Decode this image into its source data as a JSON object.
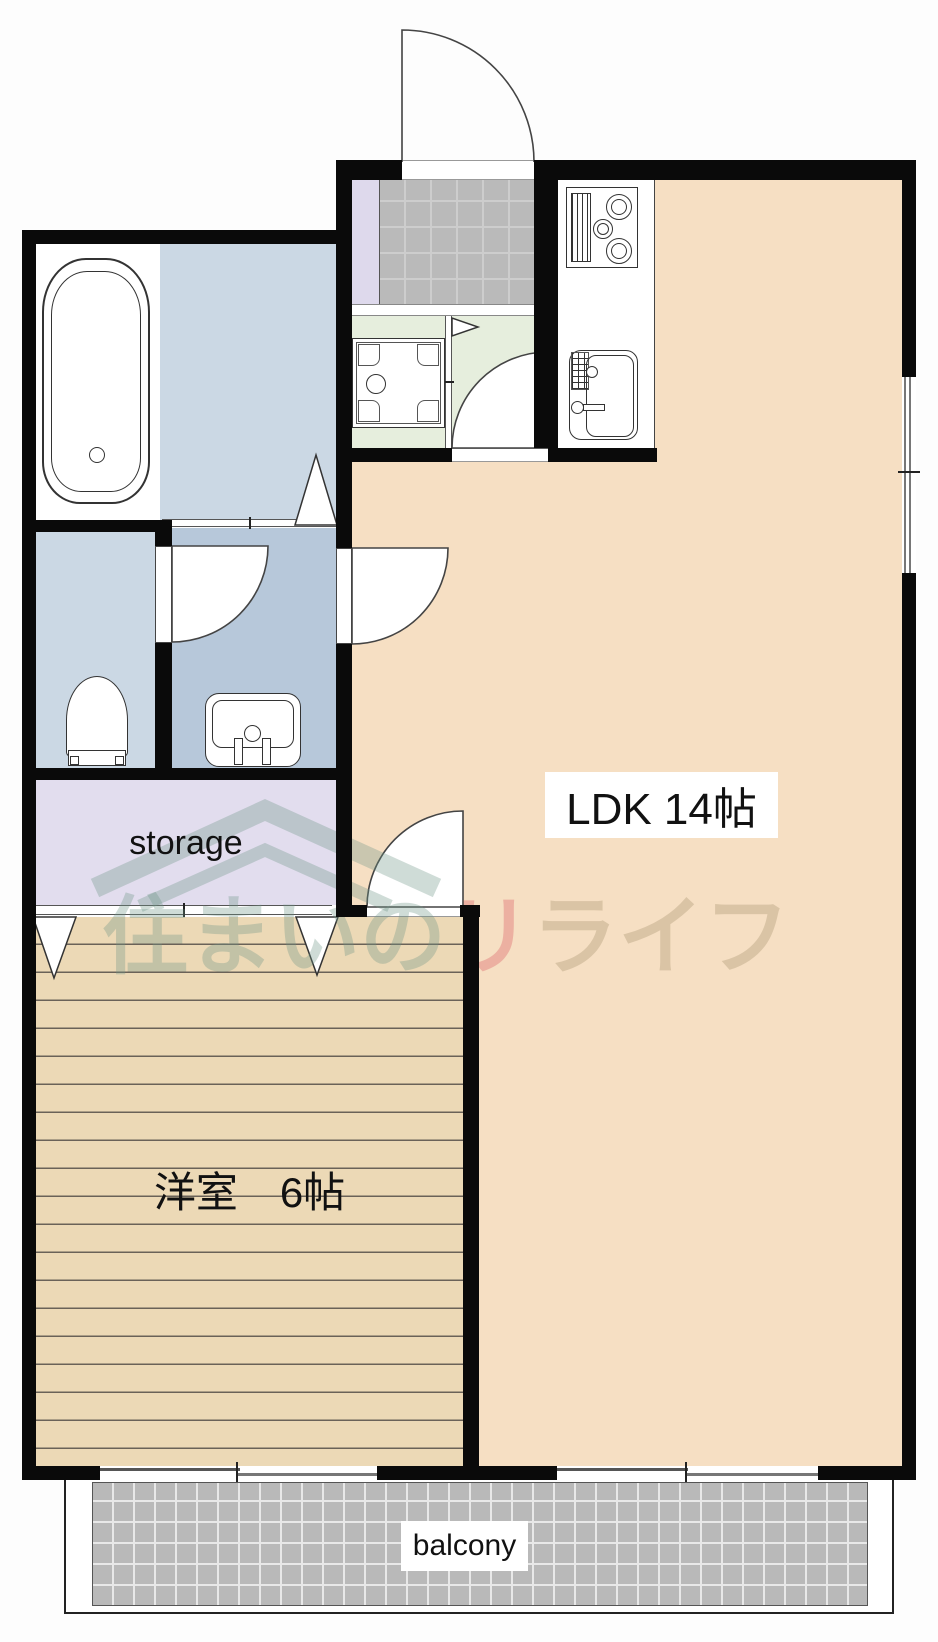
{
  "title": "apartment floor plan",
  "rooms": {
    "ldk": {
      "label": "LDK 14帖"
    },
    "western": {
      "label": "洋室　6帖"
    },
    "storage": {
      "label": "storage"
    },
    "balcony": {
      "label": "balcony"
    }
  },
  "watermark": {
    "gray": "住まいの",
    "pink": "リ",
    "tan": "ライフ"
  },
  "colors": {
    "wall": "#0a0a0a",
    "ldk": "#f6dfc3",
    "wood": "#ecd9b6",
    "wood_line": "#6a6258",
    "storage": "#e2ddee",
    "bathroom": "#cbd8e4",
    "washroom": "#b7c8da",
    "toilet": "#cbd8e4",
    "laundry": "#e6eedd",
    "tile": "#bababa",
    "tile_line": "#cdcdcd",
    "balcony_tile": "#b9b9b9",
    "balcony_line": "#e8e8e8",
    "shoebox": "#ded9ec",
    "stroke": "#333333",
    "label": "#111111"
  }
}
